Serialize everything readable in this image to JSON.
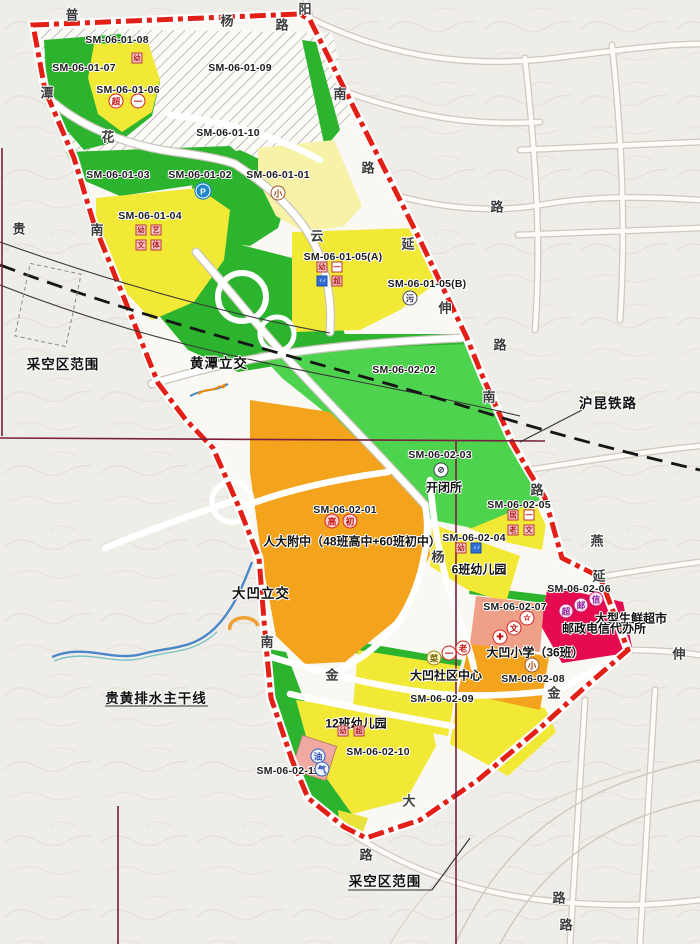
{
  "parcels": [
    {
      "code": "SM-06-01-08"
    },
    {
      "code": "SM-06-01-07"
    },
    {
      "code": "SM-06-01-06"
    },
    {
      "code": "SM-06-01-09"
    },
    {
      "code": "SM-06-01-10"
    },
    {
      "code": "SM-06-01-03"
    },
    {
      "code": "SM-06-01-02"
    },
    {
      "code": "SM-06-01-01"
    },
    {
      "code": "SM-06-01-04"
    },
    {
      "code": "SM-06-01-05(A)"
    },
    {
      "code": "SM-06-01-05(B)"
    },
    {
      "code": "SM-06-02-02"
    },
    {
      "code": "SM-06-02-03"
    },
    {
      "code": "SM-06-02-01"
    },
    {
      "code": "SM-06-02-05"
    },
    {
      "code": "SM-06-02-04"
    },
    {
      "code": "SM-06-02-06"
    },
    {
      "code": "SM-06-02-07"
    },
    {
      "code": "SM-06-02-08"
    },
    {
      "code": "SM-06-02-09"
    },
    {
      "code": "SM-06-02-10"
    },
    {
      "code": "SM-06-02-11"
    }
  ],
  "facilities": {
    "switch_station": "开闭所",
    "middle_school": "人大附中（48班高中+60班初中）",
    "kindergarten_6": "6班幼儿园",
    "community_center": "大凹社区中心",
    "primary_school": "大凹小学（36班）",
    "kindergarten_12": "12班幼儿园",
    "fresh_supermarket": "大型生鲜超市",
    "post_telecom": "邮政电信代办所"
  },
  "annotations": {
    "mined_area_left": "采空区范围",
    "mined_area_bottom": "采空区范围",
    "railway": "沪昆铁路",
    "interchange_north": "黄潭立交",
    "interchange_south": "大凹立交",
    "drainage_main": "贵黄排水主干线"
  },
  "roads": [
    "普",
    "杨",
    "路",
    "阳",
    "南",
    "路",
    "潭",
    "花",
    "贵",
    "南",
    "云",
    "延",
    "伸",
    "路",
    "路",
    "南",
    "路",
    "燕",
    "延",
    "伸",
    "杨",
    "南",
    "金",
    "金",
    "大",
    "路",
    "路",
    "路"
  ],
  "markers": {
    "circles": [
      {
        "name": "parking",
        "char": "P"
      },
      {
        "name": "primary-school",
        "char": "小"
      },
      {
        "name": "supermarket",
        "char": "超"
      },
      {
        "name": "farmers-market",
        "char": "一"
      },
      {
        "name": "sewage-plant",
        "char": "污"
      },
      {
        "name": "switch-station",
        "char": "⊘"
      },
      {
        "name": "high-school",
        "char": "高"
      },
      {
        "name": "junior-middle-school",
        "char": "初"
      },
      {
        "name": "culture-star",
        "char": "☆"
      },
      {
        "name": "culture",
        "char": "文"
      },
      {
        "name": "clinic-cross",
        "char": "✚"
      },
      {
        "name": "supermarket",
        "char": "超"
      },
      {
        "name": "post-office",
        "char": "邮"
      },
      {
        "name": "telecom-office",
        "char": "信"
      },
      {
        "name": "primary-school",
        "char": "小"
      },
      {
        "name": "vegetable-market",
        "char": "菜"
      },
      {
        "name": "farmers-market",
        "char": "一"
      },
      {
        "name": "elderly-care",
        "char": "老"
      },
      {
        "name": "gas-oil-station",
        "char": "油"
      },
      {
        "name": "gas-station",
        "char": "气"
      }
    ],
    "squares": [
      {
        "name": "kindergarten",
        "char": "幼"
      },
      {
        "name": "kindergarten",
        "char": "幼"
      },
      {
        "name": "art-facility",
        "char": "艺"
      },
      {
        "name": "culture-facility",
        "char": "文"
      },
      {
        "name": "sports-facility",
        "char": "体"
      },
      {
        "name": "kindergarten",
        "char": "幼"
      },
      {
        "name": "farmers-market",
        "char": "一"
      },
      {
        "name": "public-toilet",
        "char": "♀♂"
      },
      {
        "name": "supermarket",
        "char": "超"
      },
      {
        "name": "residence-service",
        "char": "居"
      },
      {
        "name": "farmers-market",
        "char": "一"
      },
      {
        "name": "elderly-care",
        "char": "老"
      },
      {
        "name": "culture-facility",
        "char": "文"
      },
      {
        "name": "kindergarten",
        "char": "幼"
      },
      {
        "name": "public-toilet",
        "char": "♀♂"
      },
      {
        "name": "kindergarten",
        "char": "幼"
      },
      {
        "name": "supermarket",
        "char": "超"
      }
    ]
  }
}
